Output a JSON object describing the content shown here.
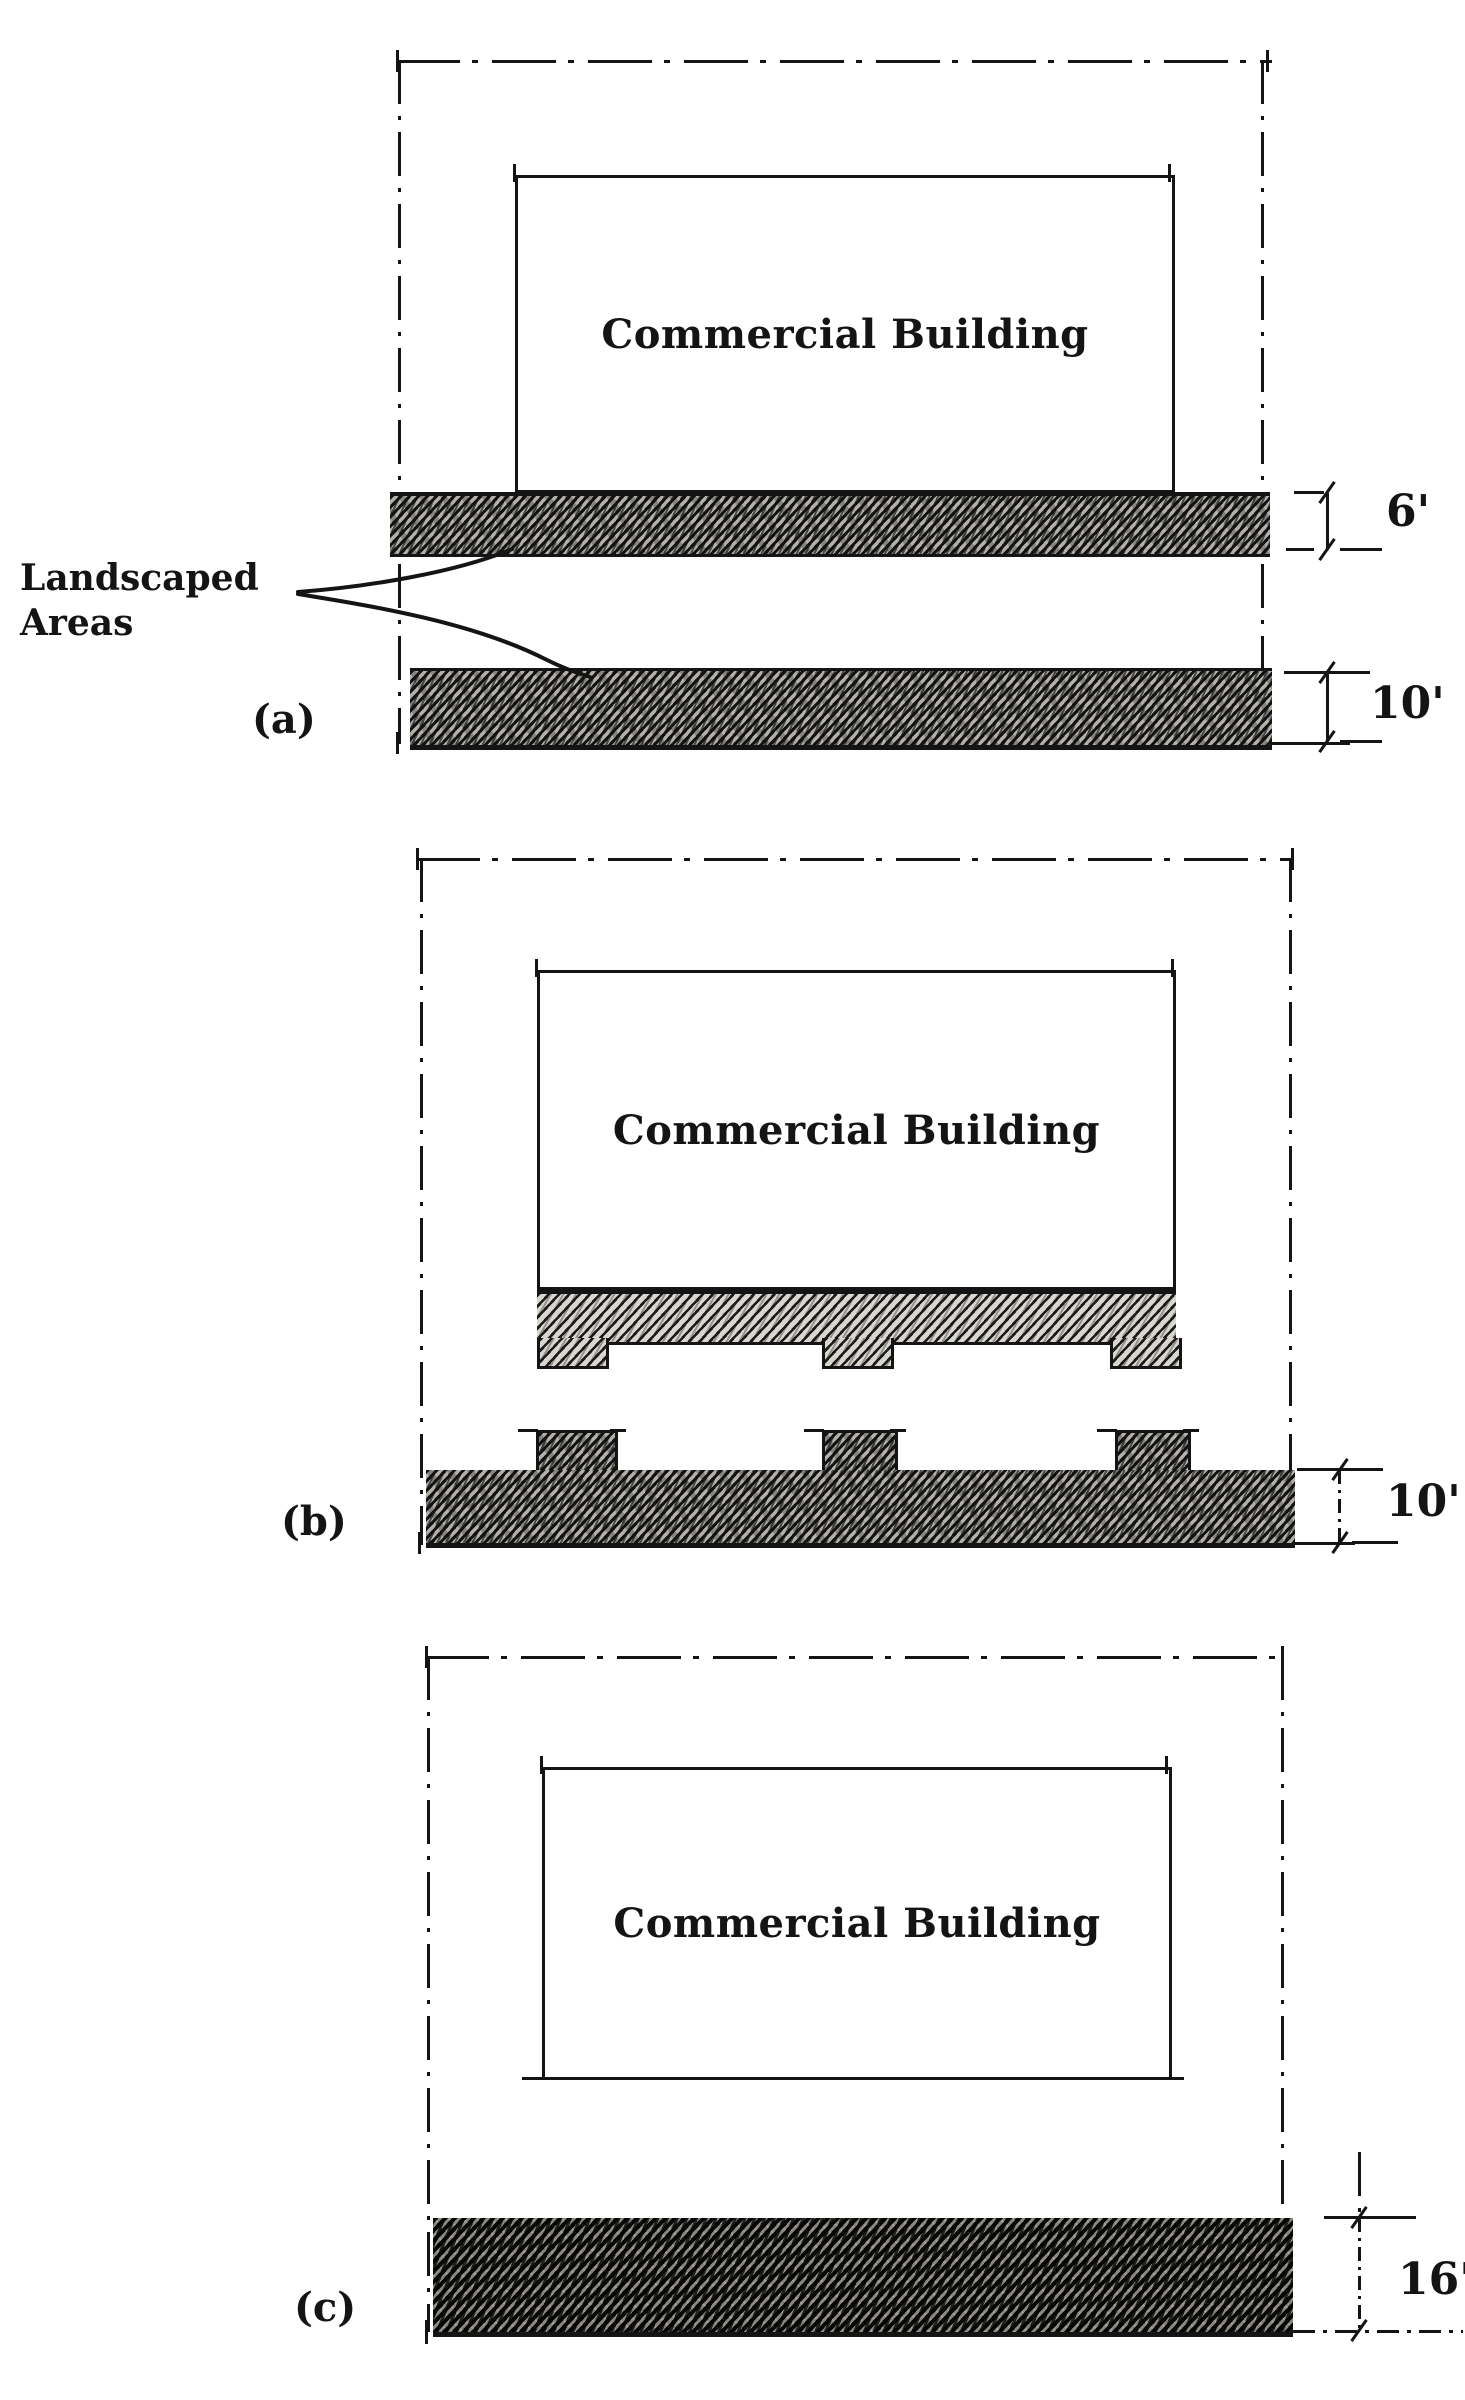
{
  "figure": {
    "ink_color": "#141414",
    "paper_color": "#ffffff",
    "annotation": {
      "line1": "Landscaped",
      "line2": "Areas"
    },
    "panels": [
      {
        "tag": "(a)",
        "building_label": "Commercial Building",
        "dims": [
          {
            "value": "6'"
          },
          {
            "value": "10'"
          }
        ]
      },
      {
        "tag": "(b)",
        "building_label": "Commercial Building",
        "dims": [
          {
            "value": "10'"
          }
        ]
      },
      {
        "tag": "(c)",
        "building_label": "Commercial Building",
        "dims": [
          {
            "value": "16'"
          }
        ]
      }
    ]
  }
}
